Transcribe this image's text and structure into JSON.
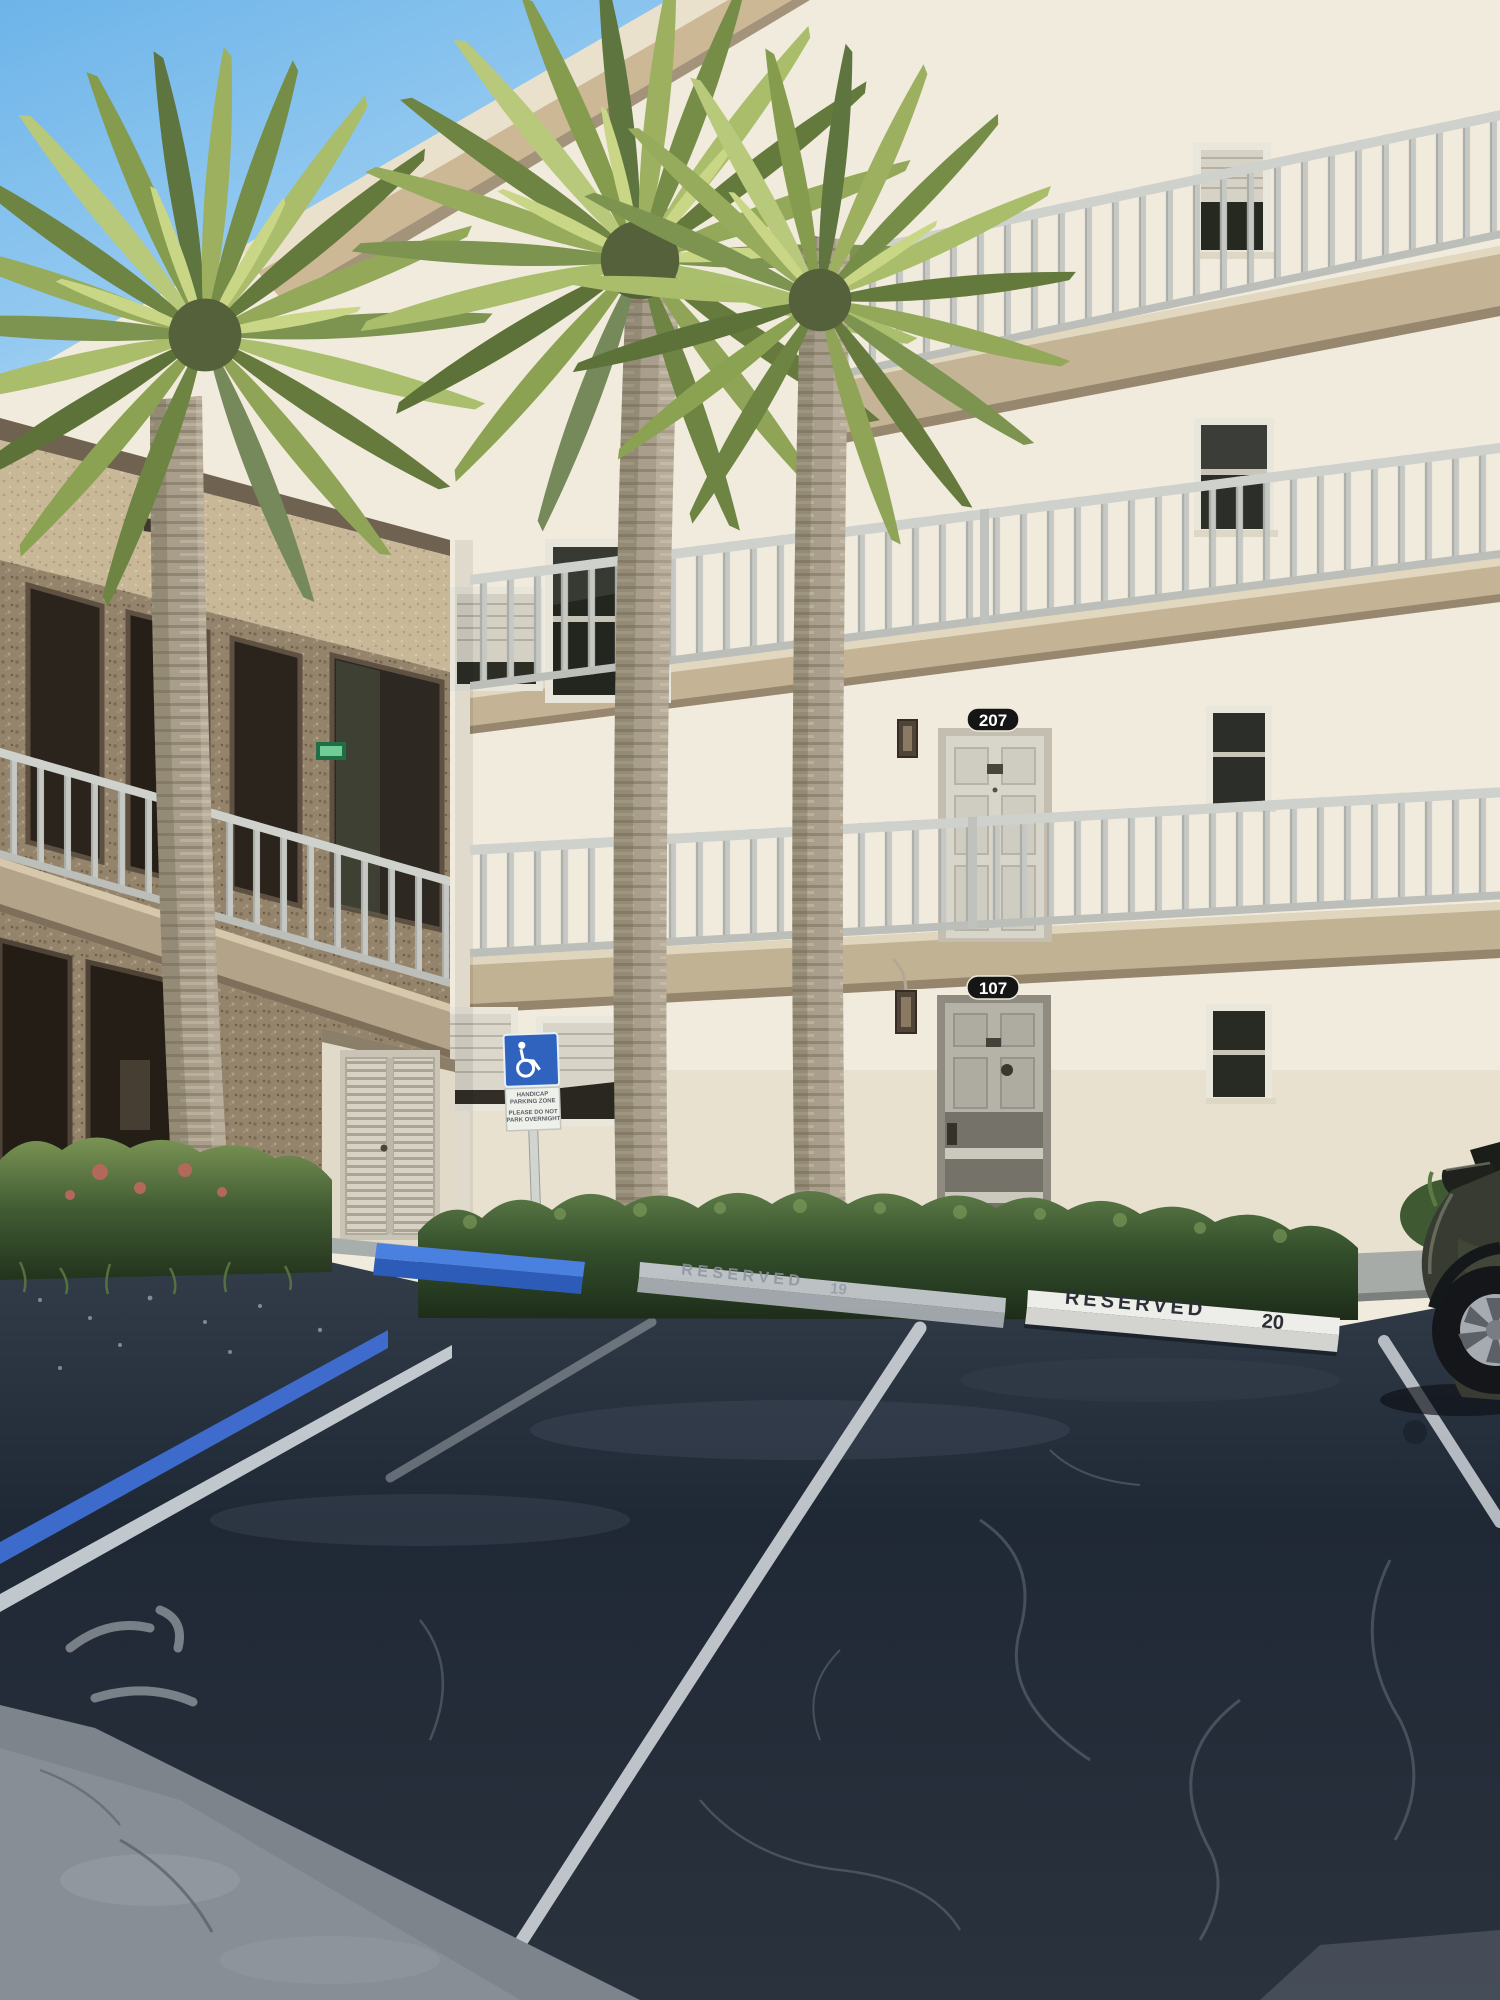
{
  "scene": {
    "type": "photograph",
    "description": "Cream stucco multi-story condominium with open walkway railings, tall sabal palm trees, hedges, a handicap parking sign and reserved parking stalls on dark asphalt in bright Florida sunlight",
    "building": {
      "unit_plaque_upper": "207",
      "unit_plaque_lower": "107"
    },
    "parking": {
      "stop_19": {
        "label": "RESERVED",
        "number": "19"
      },
      "stop_20": {
        "label": "RESERVED",
        "number": "20"
      }
    },
    "handicap_sign": {
      "line1": "HANDICAP",
      "line2": "PARKING ZONE",
      "line3": "PLEASE DO NOT",
      "line4": "PARK OVERNIGHT"
    },
    "colors": {
      "sky": "#8ec6ee",
      "stucco": "#f1ebdd",
      "fascia_tan": "#cbb795",
      "railing": "#c8cac7",
      "pebble_wall": "#95856d",
      "hedge": "#3c5a33",
      "asphalt": "#232c37",
      "curb_white": "#edeee9",
      "curb_blue": "#3a6fd8",
      "palm_green": "#8aa251",
      "trunk": "#a79d8a"
    }
  }
}
